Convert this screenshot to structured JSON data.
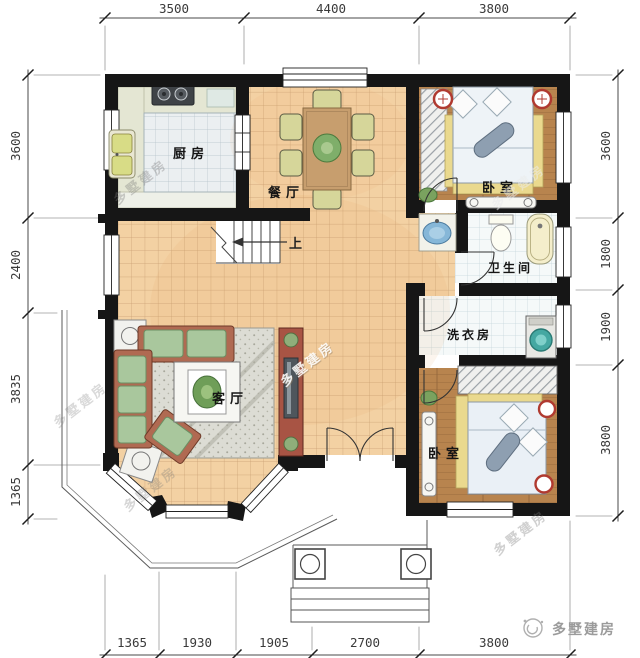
{
  "dimensions": {
    "top": [
      "3500",
      "4400",
      "3800"
    ],
    "bottom": [
      "1365",
      "1930",
      "1905",
      "2700",
      "3800"
    ],
    "left": [
      "3600",
      "2400",
      "3835",
      "1365"
    ],
    "right": [
      "3600",
      "1800",
      "1900",
      "3800"
    ]
  },
  "rooms": {
    "kitchen": "厨房",
    "dining": "餐厅",
    "bedroom_top": "卧室",
    "bathroom": "卫生间",
    "laundry": "洗衣房",
    "living": "客厅",
    "bedroom_bottom": "卧室"
  },
  "stairs": {
    "up_label": "上"
  },
  "watermark": {
    "text": "多墅建房"
  },
  "brand": {
    "name": "多墅建房"
  },
  "colors": {
    "wall": "#161616",
    "floor_tile": "#f3d1a3",
    "floor_wood": "#b8844e",
    "kitchen_tile": "#ebeff1",
    "bath_tile": "#f5f9f9",
    "sofa_green": "#a9c79d",
    "tv_cabinet_red": "#a85444",
    "accent_red": "#b03a30",
    "water_blue": "#86b7d8",
    "dim_text": "#3a3a3a"
  }
}
